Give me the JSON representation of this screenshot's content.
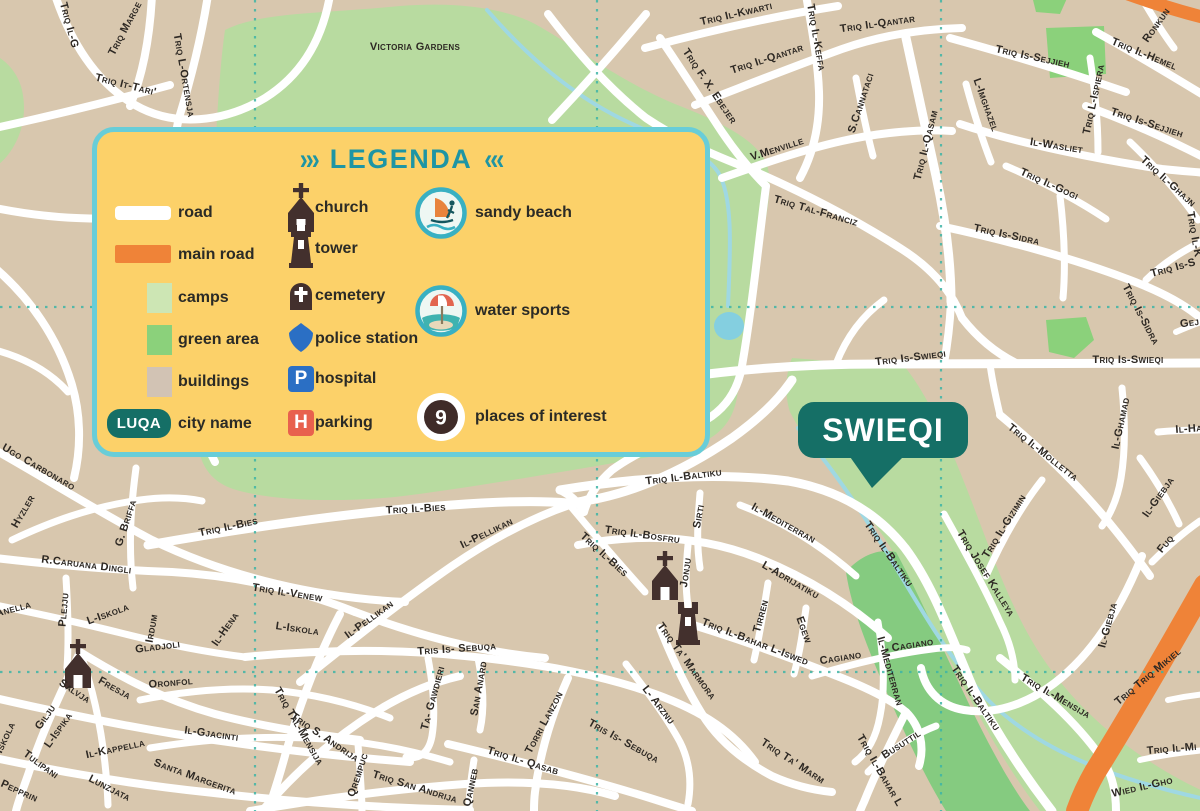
{
  "map": {
    "city_badge": "SWIEQI",
    "colors": {
      "background": "#d8c7ae",
      "road": "#ffffff",
      "main_road": "#ef8338",
      "garden_green": "#b8dba0",
      "green_area": "#8bd17b",
      "camps": "#cde6b4",
      "stream": "#9fd8e2",
      "gridline": "#3eb5a6",
      "badge": "#156f66",
      "icon_brown": "#43302d",
      "label": "#2d2823"
    },
    "icons": [
      {
        "type": "church",
        "x": 665,
        "y": 578
      },
      {
        "type": "tower",
        "x": 688,
        "y": 626
      },
      {
        "type": "church",
        "x": 78,
        "y": 666
      }
    ],
    "street_labels": [
      {
        "t": "Triq Marge",
        "x": 128,
        "y": 30,
        "r": -62
      },
      {
        "t": "Triq It-Tari'",
        "x": 125,
        "y": 88,
        "r": 14
      },
      {
        "t": "Triq L-Ortensja",
        "x": 181,
        "y": 76,
        "r": 80
      },
      {
        "t": "Triq Il-G",
        "x": 66,
        "y": 26,
        "r": 75
      },
      {
        "t": "Triq Il-Kwarti",
        "x": 737,
        "y": 17,
        "r": -13
      },
      {
        "t": "Triq F. X. Ebejer",
        "x": 707,
        "y": 88,
        "r": 56
      },
      {
        "t": "Triq Il-Qantar",
        "x": 768,
        "y": 62,
        "r": -18
      },
      {
        "t": "Triq Il-Keffa",
        "x": 813,
        "y": 38,
        "r": 80
      },
      {
        "t": "Triq Il-Qantar",
        "x": 878,
        "y": 27,
        "r": -8
      },
      {
        "t": "V.Menville",
        "x": 778,
        "y": 152,
        "r": -18
      },
      {
        "t": "S.Cannataci",
        "x": 864,
        "y": 104,
        "r": -72
      },
      {
        "t": "Triq Il-Qasam",
        "x": 929,
        "y": 146,
        "r": -76
      },
      {
        "t": "Triq Tal-Franciz",
        "x": 815,
        "y": 214,
        "r": 16
      },
      {
        "t": "Triq Is-Sejjieh",
        "x": 1032,
        "y": 60,
        "r": 12
      },
      {
        "t": "Triq Il-Hemel",
        "x": 1143,
        "y": 57,
        "r": 22
      },
      {
        "t": "Ronkun",
        "x": 1159,
        "y": 27,
        "r": -55
      },
      {
        "t": "Triq L-Ispiera",
        "x": 1097,
        "y": 100,
        "r": -78
      },
      {
        "t": "Triq Is-Sejjieh",
        "x": 1146,
        "y": 126,
        "r": 18
      },
      {
        "t": "Il-Wasliet",
        "x": 1056,
        "y": 149,
        "r": 9
      },
      {
        "t": "L-Imghazel",
        "x": 983,
        "y": 106,
        "r": 70
      },
      {
        "t": "Triq Il-Ghajn",
        "x": 1166,
        "y": 184,
        "r": 42
      },
      {
        "t": "Triq Il-K",
        "x": 1191,
        "y": 235,
        "r": 80
      },
      {
        "t": "Triq Il-Gogi",
        "x": 1048,
        "y": 187,
        "r": 24
      },
      {
        "t": "Triq Is-Sidra",
        "x": 1006,
        "y": 238,
        "r": 12
      },
      {
        "t": "Triq Is-Sidra",
        "x": 1138,
        "y": 316,
        "r": 62
      },
      {
        "t": "Triq Is-S",
        "x": 1174,
        "y": 271,
        "r": -15
      },
      {
        "t": "Gej",
        "x": 1190,
        "y": 326,
        "r": -8
      },
      {
        "t": "Victoria Gardens",
        "x": 415,
        "y": 50,
        "r": 0,
        "s": 13,
        "ls": 1.2,
        "c": "#333322"
      },
      {
        "t": "Triq Is-Swieqi",
        "x": 911,
        "y": 361,
        "r": -7
      },
      {
        "t": "Triq Is-Swieqi",
        "x": 1128,
        "y": 363,
        "r": 0
      },
      {
        "t": "Triq Il-Molletta",
        "x": 1041,
        "y": 455,
        "r": 38
      },
      {
        "t": "Il-Ghamad",
        "x": 1124,
        "y": 424,
        "r": -78
      },
      {
        "t": "Il-Ha",
        "x": 1189,
        "y": 432,
        "r": -4
      },
      {
        "t": "Triq Il-Gizimin",
        "x": 1007,
        "y": 528,
        "r": -58
      },
      {
        "t": "Triq Josef Kalleya",
        "x": 983,
        "y": 575,
        "r": 58
      },
      {
        "t": "Il-Giebja",
        "x": 1161,
        "y": 499,
        "r": -55
      },
      {
        "t": "Fuq",
        "x": 1168,
        "y": 546,
        "r": -50
      },
      {
        "t": "Il-Giebja",
        "x": 1111,
        "y": 626,
        "r": -75
      },
      {
        "t": "Triq Il-Baltiku",
        "x": 684,
        "y": 480,
        "r": -7
      },
      {
        "t": "Triq Il-Baltiku",
        "x": 886,
        "y": 556,
        "r": 55
      },
      {
        "t": "Triq Il-Baltiku",
        "x": 973,
        "y": 700,
        "r": 55
      },
      {
        "t": "Sirti",
        "x": 702,
        "y": 517,
        "r": -80
      },
      {
        "t": "Il-Mediterran",
        "x": 782,
        "y": 526,
        "r": 29
      },
      {
        "t": "Il-Mediterran",
        "x": 887,
        "y": 672,
        "r": 74
      },
      {
        "t": "Triq Il-Bosfru",
        "x": 642,
        "y": 538,
        "r": 8
      },
      {
        "t": "Jonju",
        "x": 689,
        "y": 573,
        "r": -82
      },
      {
        "t": "L-Adrijatiku",
        "x": 789,
        "y": 583,
        "r": 30
      },
      {
        "t": "Tirren",
        "x": 764,
        "y": 617,
        "r": -75
      },
      {
        "t": "Egew",
        "x": 801,
        "y": 631,
        "r": 70
      },
      {
        "t": "Triq Il-Bahar L-Iswed",
        "x": 754,
        "y": 645,
        "r": 21
      },
      {
        "t": "Triq Il-Bahar L",
        "x": 877,
        "y": 772,
        "r": 60
      },
      {
        "t": "Cagiano",
        "x": 841,
        "y": 661,
        "r": -9
      },
      {
        "t": "Cagiano",
        "x": 913,
        "y": 648,
        "r": -9
      },
      {
        "t": "Busuttil",
        "x": 903,
        "y": 747,
        "r": -33
      },
      {
        "t": "Triq Ta' Marmora",
        "x": 684,
        "y": 663,
        "r": 54
      },
      {
        "t": "Triq Ta' Marm",
        "x": 791,
        "y": 764,
        "r": 33
      },
      {
        "t": "L- Arznu",
        "x": 656,
        "y": 707,
        "r": 52
      },
      {
        "t": "Tris Is- Sebuqa",
        "x": 457,
        "y": 652,
        "r": -4
      },
      {
        "t": "Tris Is- Sebuqa",
        "x": 622,
        "y": 744,
        "r": 29
      },
      {
        "t": "Ta- Gawdieri",
        "x": 436,
        "y": 699,
        "r": -75
      },
      {
        "t": "San Anard",
        "x": 482,
        "y": 689,
        "r": -80
      },
      {
        "t": "Torri Lanzon",
        "x": 547,
        "y": 724,
        "r": -62
      },
      {
        "t": "Triq Il- Qasab",
        "x": 522,
        "y": 764,
        "r": 17
      },
      {
        "t": "Qanneb",
        "x": 474,
        "y": 788,
        "r": -78
      },
      {
        "t": "Qrempuc",
        "x": 361,
        "y": 776,
        "r": -72
      },
      {
        "t": "Triq S. Andrija",
        "x": 323,
        "y": 740,
        "r": 34
      },
      {
        "t": "Triq San Andrija",
        "x": 414,
        "y": 790,
        "r": 17
      },
      {
        "t": "Triq Tal-Mensija",
        "x": 296,
        "y": 728,
        "r": 60
      },
      {
        "t": "Il-Pellikan",
        "x": 488,
        "y": 536,
        "r": -26
      },
      {
        "t": "Il-Pellikan",
        "x": 371,
        "y": 622,
        "r": -36
      },
      {
        "t": "Triq Il-Bies",
        "x": 416,
        "y": 512,
        "r": -3
      },
      {
        "t": "Triq Il-Bies",
        "x": 602,
        "y": 557,
        "r": 42
      },
      {
        "t": "Triq Il-Bies",
        "x": 229,
        "y": 530,
        "r": -12
      },
      {
        "t": "Triq Il-Venew",
        "x": 287,
        "y": 596,
        "r": 9
      },
      {
        "t": "L-Iskola",
        "x": 109,
        "y": 617,
        "r": -20
      },
      {
        "t": "L-Iskola",
        "x": 297,
        "y": 632,
        "r": 8
      },
      {
        "t": "L-Iskola",
        "x": 6,
        "y": 744,
        "r": -65
      },
      {
        "t": "Irdum",
        "x": 155,
        "y": 629,
        "r": -80
      },
      {
        "t": "Gladjoli",
        "x": 158,
        "y": 650,
        "r": -7
      },
      {
        "t": "Il-Hena",
        "x": 228,
        "y": 631,
        "r": -55
      },
      {
        "t": "R.Caruana Dingli",
        "x": 86,
        "y": 568,
        "r": 7
      },
      {
        "t": "Plejju",
        "x": 67,
        "y": 610,
        "r": -85
      },
      {
        "t": "Anella",
        "x": 14,
        "y": 612,
        "r": -15
      },
      {
        "t": "Ugo Carbonaro",
        "x": 37,
        "y": 470,
        "r": 30
      },
      {
        "t": "Hyzler",
        "x": 26,
        "y": 513,
        "r": -60
      },
      {
        "t": "G. Briffa",
        "x": 129,
        "y": 524,
        "r": -72
      },
      {
        "t": "Salvja",
        "x": 73,
        "y": 694,
        "r": 33
      },
      {
        "t": "Fresja",
        "x": 113,
        "y": 691,
        "r": 29
      },
      {
        "t": "Oronfol",
        "x": 171,
        "y": 686,
        "r": -5
      },
      {
        "t": "Gilju",
        "x": 48,
        "y": 719,
        "r": -55
      },
      {
        "t": "L-Ispika",
        "x": 61,
        "y": 732,
        "r": -55
      },
      {
        "t": "Tulipani",
        "x": 39,
        "y": 767,
        "r": 36
      },
      {
        "t": "Pepprin",
        "x": 18,
        "y": 794,
        "r": 24
      },
      {
        "t": "Il-Kappella",
        "x": 116,
        "y": 752,
        "r": -12
      },
      {
        "t": "Il-Gjacinti",
        "x": 211,
        "y": 737,
        "r": 8
      },
      {
        "t": "Santa Margerita",
        "x": 194,
        "y": 780,
        "r": 20
      },
      {
        "t": "Lunzjata",
        "x": 108,
        "y": 791,
        "r": 27
      },
      {
        "t": "Triq Il-Mensija",
        "x": 1054,
        "y": 699,
        "r": 30
      },
      {
        "t": "Triq Triq Mikiel",
        "x": 1150,
        "y": 679,
        "r": -40,
        "s": 13,
        "c": "#3e2512"
      },
      {
        "t": "Triq Il-Mi",
        "x": 1172,
        "y": 752,
        "r": -5
      },
      {
        "t": "Wied Il-Gho",
        "x": 1143,
        "y": 790,
        "r": -13,
        "s": 12,
        "ls": 3
      }
    ]
  },
  "legend": {
    "chevrons_left": "›››",
    "chevrons_right": "‹‹‹",
    "title": "LEGENDA",
    "area_items": [
      {
        "label": "road"
      },
      {
        "label": "main road"
      },
      {
        "label": "camps"
      },
      {
        "label": "green area"
      },
      {
        "label": "buildings"
      },
      {
        "label": "city name",
        "badge_text": "LUQA"
      }
    ],
    "symbol_items": [
      {
        "label": "church"
      },
      {
        "label": "tower"
      },
      {
        "label": "cemetery"
      },
      {
        "label": "police station"
      },
      {
        "label": "hospital",
        "letter": "P"
      },
      {
        "label": "parking",
        "letter": "H"
      }
    ],
    "poi_items": [
      {
        "label": "sandy beach"
      },
      {
        "label": "water sports"
      },
      {
        "label": "places of interest",
        "number": "9"
      }
    ]
  }
}
